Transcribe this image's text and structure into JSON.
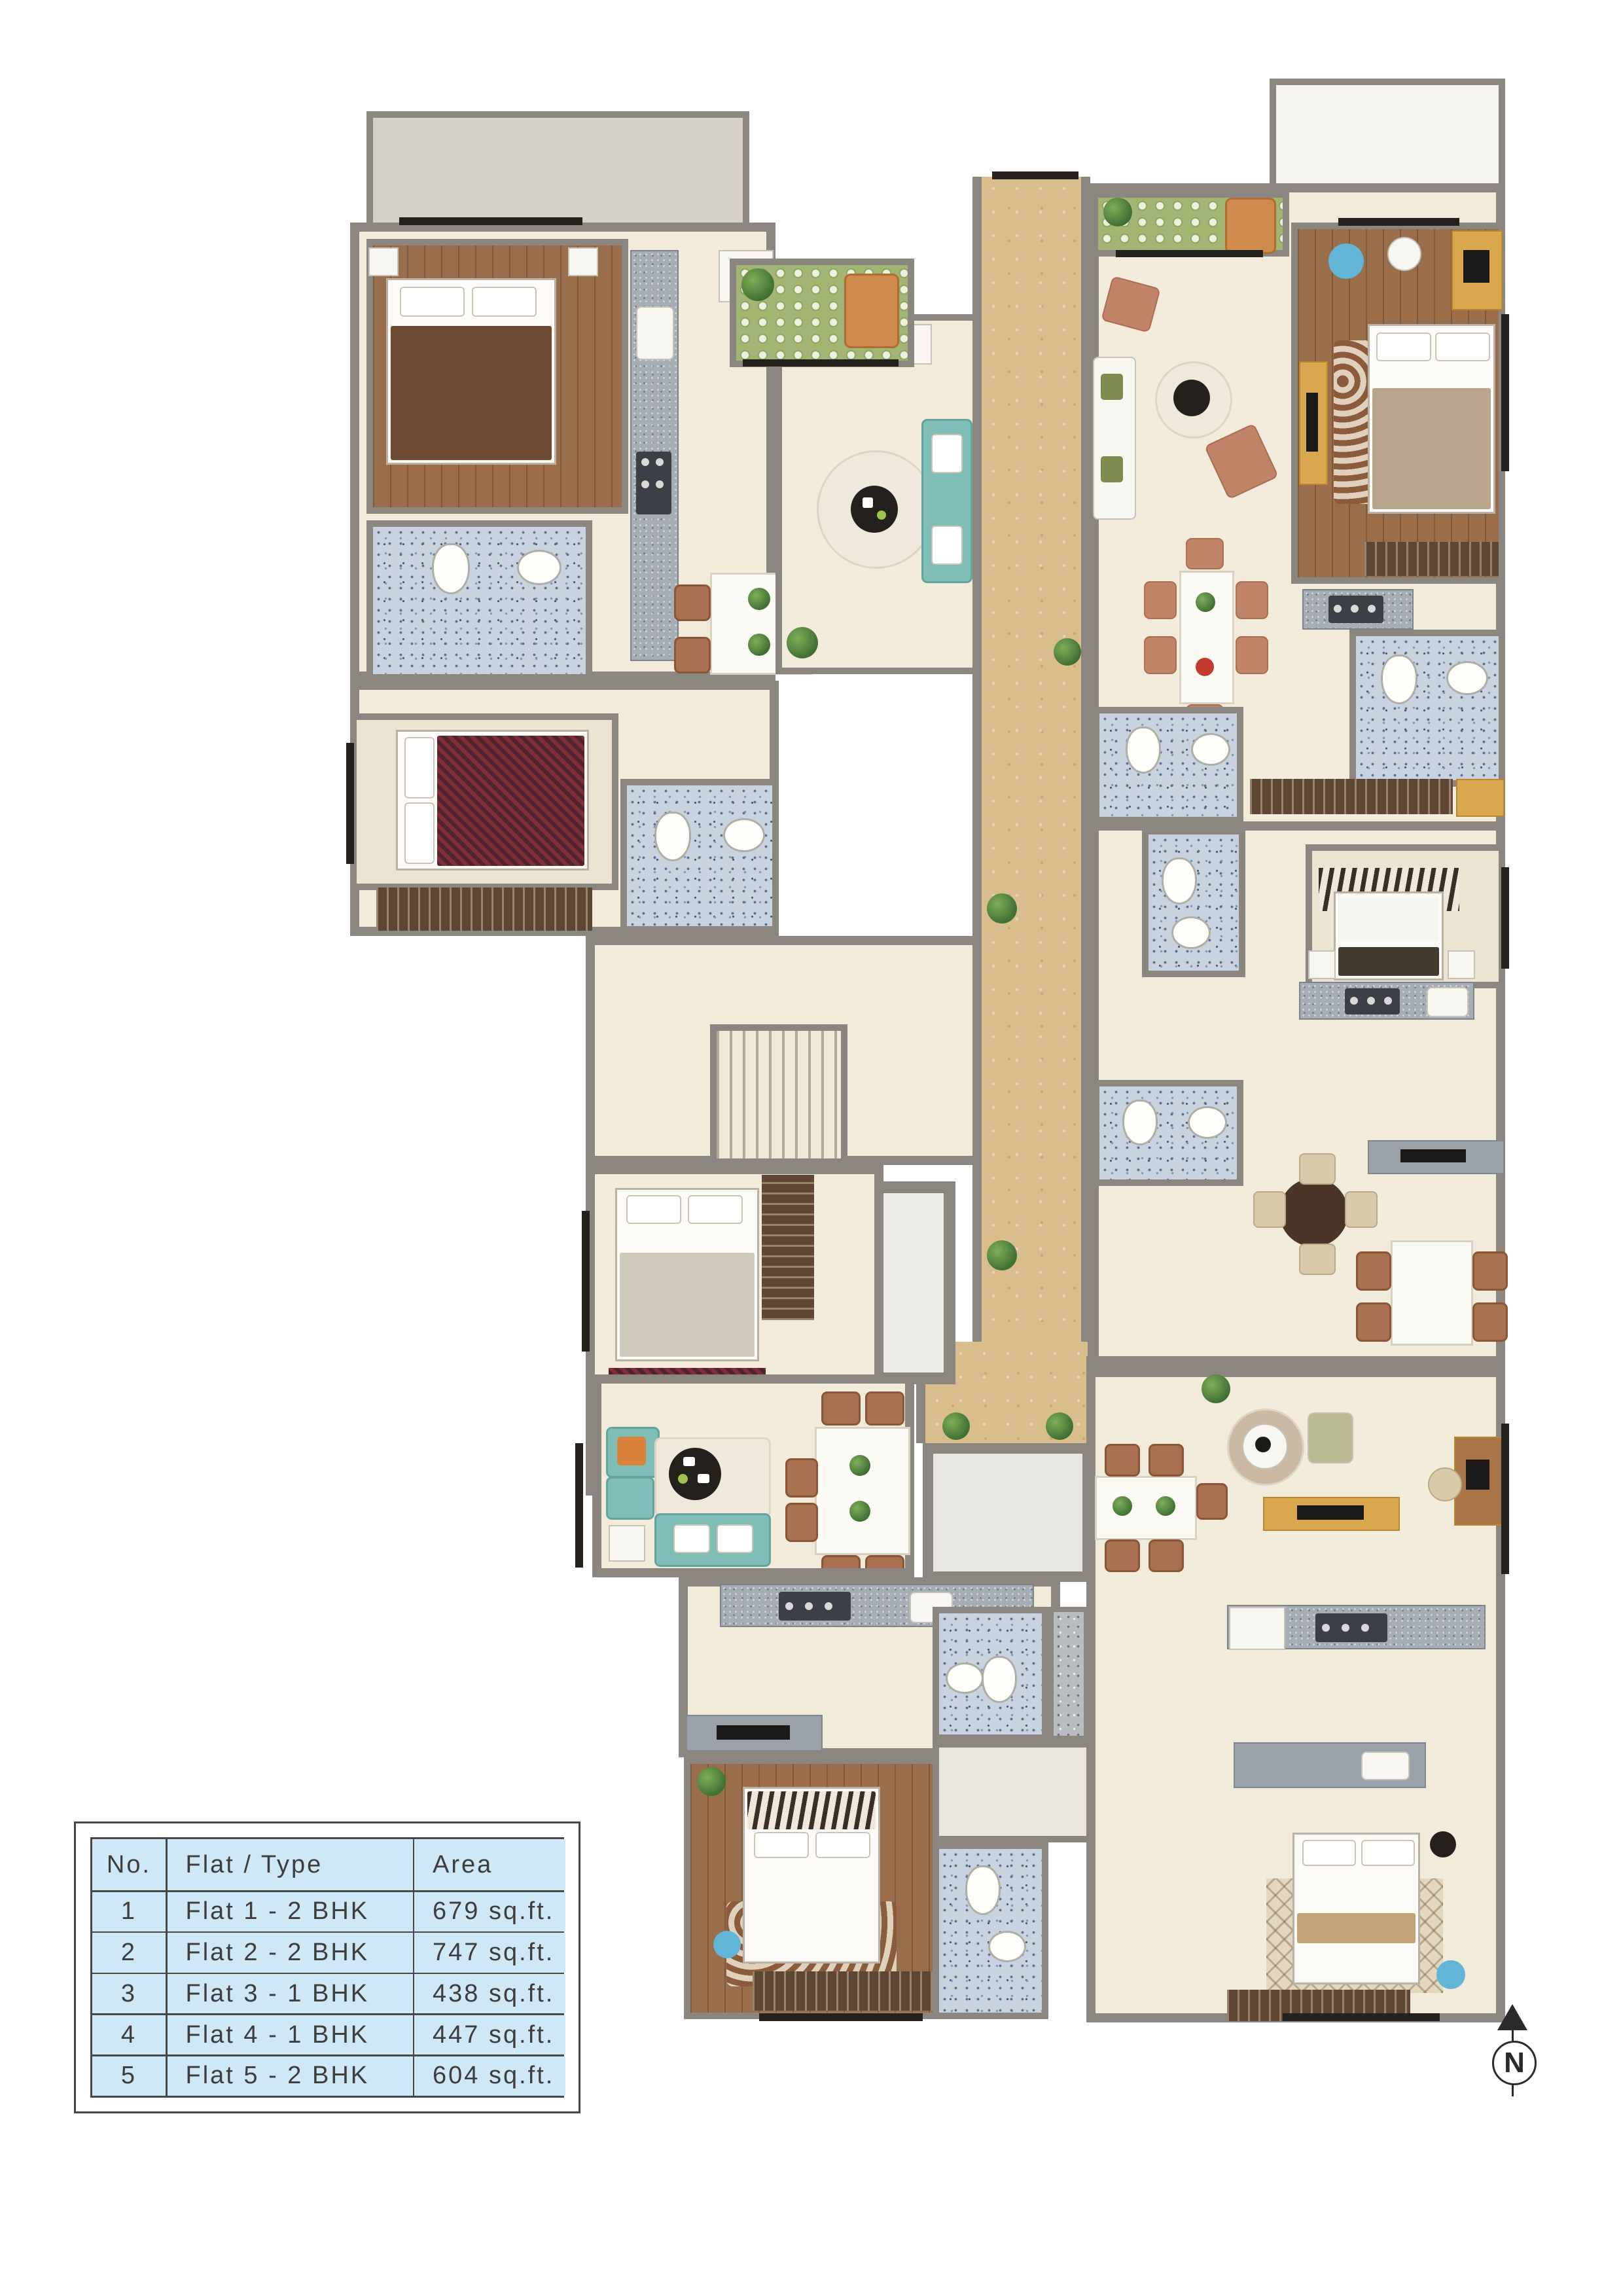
{
  "legend_table": {
    "headers": {
      "no": "No.",
      "flat_type": "Flat / Type",
      "area": "Area"
    },
    "rows": [
      {
        "no": "1",
        "flat_type": "Flat 1 - 2 BHK",
        "area": "679 sq.ft."
      },
      {
        "no": "2",
        "flat_type": "Flat 2 - 2 BHK",
        "area": "747 sq.ft."
      },
      {
        "no": "3",
        "flat_type": "Flat 3 - 1 BHK",
        "area": "438 sq.ft."
      },
      {
        "no": "4",
        "flat_type": "Flat 4 - 1 BHK",
        "area": "447 sq.ft."
      },
      {
        "no": "5",
        "flat_type": "Flat 5 - 2 BHK",
        "area": "604 sq.ft."
      }
    ]
  },
  "compass": {
    "label": "N"
  },
  "colors": {
    "table_fill": "#cfe8f7",
    "table_line": "#474747",
    "wall": "#8b8680",
    "floor_cream": "#f2ebd9",
    "corridor_tan": "#d9bd8d",
    "bath_tile": "#c9d3e0",
    "balcony_green": "#a2b575",
    "wood_floor": "#9a6e4b"
  }
}
